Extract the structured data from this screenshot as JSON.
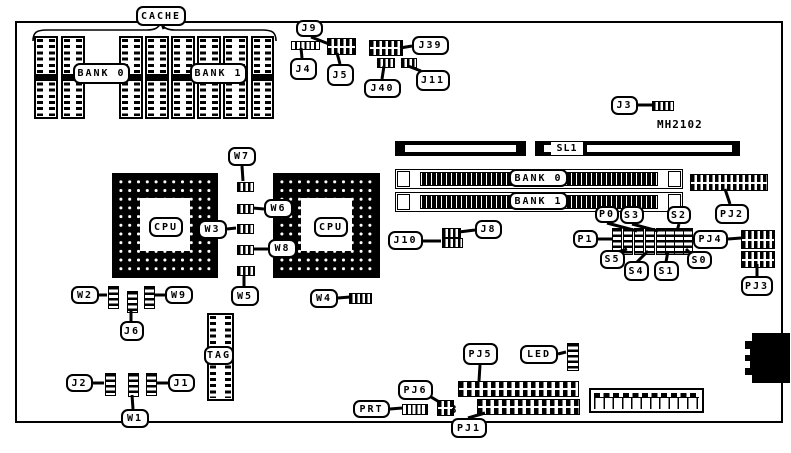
{
  "board": {
    "part_number": "MH2102",
    "ink": "#000000",
    "paper": "#ffffff"
  },
  "floating_texts": [
    {
      "id": "part-number",
      "text": "MH2102",
      "x": 657,
      "y": 118
    },
    {
      "id": "pj6-pin-3",
      "text": "3",
      "x": 450,
      "y": 403
    }
  ],
  "labels": [
    {
      "id": "cache",
      "text": "CACHE",
      "x": 136,
      "y": 6,
      "w": 50,
      "h": 20,
      "tail": [
        162,
        24,
        164,
        29
      ]
    },
    {
      "id": "cache-bank0",
      "text": "BANK 0",
      "x": 73,
      "y": 63,
      "w": 57,
      "h": 21,
      "tail": null
    },
    {
      "id": "cache-bank1",
      "text": "BANK 1",
      "x": 190,
      "y": 63,
      "w": 57,
      "h": 21,
      "tail": null
    },
    {
      "id": "j9",
      "text": "J9",
      "x": 296,
      "y": 20,
      "w": 27,
      "h": 17,
      "tail": [
        311,
        37,
        329,
        44
      ]
    },
    {
      "id": "j4",
      "text": "J4",
      "x": 290,
      "y": 58,
      "w": 27,
      "h": 22,
      "tail": [
        302,
        58,
        301,
        48
      ]
    },
    {
      "id": "j5",
      "text": "J5",
      "x": 327,
      "y": 64,
      "w": 27,
      "h": 22,
      "tail": [
        340,
        64,
        337,
        53
      ]
    },
    {
      "id": "j39",
      "text": "J39",
      "x": 412,
      "y": 36,
      "w": 37,
      "h": 19,
      "tail": [
        412,
        46,
        400,
        48
      ]
    },
    {
      "id": "j40",
      "text": "J40",
      "x": 364,
      "y": 79,
      "w": 37,
      "h": 19,
      "tail": [
        382,
        79,
        384,
        66
      ]
    },
    {
      "id": "j11",
      "text": "J11",
      "x": 416,
      "y": 70,
      "w": 34,
      "h": 21,
      "tail": [
        421,
        71,
        408,
        66
      ]
    },
    {
      "id": "j3",
      "text": "J3",
      "x": 611,
      "y": 96,
      "w": 27,
      "h": 19,
      "tail": [
        638,
        105,
        653,
        105
      ]
    },
    {
      "id": "sl1",
      "text": "SL1",
      "x": 551,
      "y": 142,
      "w": 32,
      "h": 13,
      "flat": true,
      "tail": null
    },
    {
      "id": "simm-bank0",
      "text": "BANK 0",
      "x": 509,
      "y": 169,
      "w": 59,
      "h": 18,
      "tail": null
    },
    {
      "id": "simm-bank1",
      "text": "BANK 1",
      "x": 509,
      "y": 192,
      "w": 59,
      "h": 18,
      "tail": null
    },
    {
      "id": "pj2",
      "text": "PJ2",
      "x": 715,
      "y": 204,
      "w": 34,
      "h": 20,
      "tail": [
        730,
        204,
        725,
        189
      ]
    },
    {
      "id": "w7",
      "text": "W7",
      "x": 228,
      "y": 147,
      "w": 28,
      "h": 19,
      "tail": [
        242,
        166,
        243,
        181
      ]
    },
    {
      "id": "w6",
      "text": "W6",
      "x": 264,
      "y": 199,
      "w": 29,
      "h": 19,
      "tail": [
        264,
        209,
        253,
        208
      ]
    },
    {
      "id": "w3",
      "text": "W3",
      "x": 198,
      "y": 220,
      "w": 29,
      "h": 19,
      "tail": [
        227,
        229,
        236,
        228
      ]
    },
    {
      "id": "w8",
      "text": "W8",
      "x": 268,
      "y": 239,
      "w": 29,
      "h": 19,
      "tail": [
        268,
        249,
        253,
        249
      ]
    },
    {
      "id": "w5",
      "text": "W5",
      "x": 231,
      "y": 286,
      "w": 28,
      "h": 20,
      "tail": [
        244,
        286,
        244,
        275
      ]
    },
    {
      "id": "w4",
      "text": "W4",
      "x": 310,
      "y": 289,
      "w": 28,
      "h": 19,
      "tail": [
        338,
        298,
        350,
        297
      ]
    },
    {
      "id": "w2",
      "text": "W2",
      "x": 71,
      "y": 286,
      "w": 28,
      "h": 18,
      "tail": [
        99,
        295,
        107,
        295
      ]
    },
    {
      "id": "w9",
      "text": "W9",
      "x": 165,
      "y": 286,
      "w": 28,
      "h": 18,
      "tail": [
        165,
        295,
        154,
        295
      ]
    },
    {
      "id": "j6",
      "text": "J6",
      "x": 120,
      "y": 321,
      "w": 24,
      "h": 20,
      "tail": [
        131,
        321,
        131,
        310
      ]
    },
    {
      "id": "j10",
      "text": "J10",
      "x": 388,
      "y": 231,
      "w": 35,
      "h": 19,
      "tail": [
        423,
        241,
        441,
        241
      ]
    },
    {
      "id": "j8",
      "text": "J8",
      "x": 475,
      "y": 220,
      "w": 27,
      "h": 19,
      "tail": [
        475,
        230,
        459,
        232
      ]
    },
    {
      "id": "p0",
      "text": "P0",
      "x": 595,
      "y": 206,
      "w": 24,
      "h": 17,
      "tail": [
        607,
        223,
        637,
        231
      ]
    },
    {
      "id": "s3",
      "text": "S3",
      "x": 620,
      "y": 206,
      "w": 24,
      "h": 18,
      "tail": [
        632,
        224,
        658,
        231
      ]
    },
    {
      "id": "s2",
      "text": "S2",
      "x": 667,
      "y": 206,
      "w": 24,
      "h": 18,
      "tail": [
        679,
        224,
        677,
        231
      ]
    },
    {
      "id": "p1",
      "text": "P1",
      "x": 573,
      "y": 230,
      "w": 25,
      "h": 18,
      "tail": [
        598,
        239,
        612,
        239
      ]
    },
    {
      "id": "s5",
      "text": "S5",
      "x": 600,
      "y": 250,
      "w": 25,
      "h": 19,
      "tail": [
        618,
        252,
        627,
        249
      ]
    },
    {
      "id": "s4",
      "text": "S4",
      "x": 624,
      "y": 261,
      "w": 25,
      "h": 20,
      "tail": [
        637,
        262,
        648,
        251
      ]
    },
    {
      "id": "s1",
      "text": "S1",
      "x": 654,
      "y": 261,
      "w": 25,
      "h": 20,
      "tail": [
        666,
        262,
        668,
        251
      ]
    },
    {
      "id": "s0",
      "text": "S0",
      "x": 687,
      "y": 251,
      "w": 25,
      "h": 18,
      "tail": [
        690,
        253,
        686,
        249
      ]
    },
    {
      "id": "pj4",
      "text": "PJ4",
      "x": 693,
      "y": 230,
      "w": 35,
      "h": 19,
      "tail": [
        728,
        239,
        741,
        238
      ]
    },
    {
      "id": "pj3",
      "text": "PJ3",
      "x": 741,
      "y": 276,
      "w": 32,
      "h": 20,
      "tail": [
        757,
        276,
        757,
        264
      ]
    },
    {
      "id": "tag",
      "text": "TAG",
      "x": 204,
      "y": 346,
      "w": 30,
      "h": 19,
      "tail": null
    },
    {
      "id": "j2",
      "text": "J2",
      "x": 66,
      "y": 374,
      "w": 27,
      "h": 18,
      "tail": [
        93,
        383,
        104,
        383
      ]
    },
    {
      "id": "j1",
      "text": "J1",
      "x": 168,
      "y": 374,
      "w": 27,
      "h": 18,
      "tail": [
        168,
        383,
        156,
        383
      ]
    },
    {
      "id": "w1",
      "text": "W1",
      "x": 121,
      "y": 409,
      "w": 28,
      "h": 19,
      "tail": [
        133,
        409,
        132,
        395
      ]
    },
    {
      "id": "pj5",
      "text": "PJ5",
      "x": 463,
      "y": 343,
      "w": 35,
      "h": 22,
      "tail": [
        480,
        365,
        479,
        381
      ]
    },
    {
      "id": "led",
      "text": "LED",
      "x": 520,
      "y": 345,
      "w": 38,
      "h": 19,
      "tail": [
        558,
        354,
        566,
        352
      ]
    },
    {
      "id": "pj6",
      "text": "PJ6",
      "x": 398,
      "y": 380,
      "w": 35,
      "h": 20,
      "tail": [
        431,
        397,
        441,
        403
      ]
    },
    {
      "id": "prt",
      "text": "PRT",
      "x": 353,
      "y": 400,
      "w": 37,
      "h": 18,
      "tail": [
        390,
        409,
        402,
        408
      ]
    },
    {
      "id": "pj1",
      "text": "PJ1",
      "x": 451,
      "y": 418,
      "w": 36,
      "h": 20,
      "tail": [
        468,
        418,
        485,
        413
      ]
    }
  ],
  "dip_chips": [
    {
      "id": "cache-chip-1",
      "x": 34,
      "y": 36,
      "w": 24,
      "h": 83
    },
    {
      "id": "cache-chip-2",
      "x": 61,
      "y": 36,
      "w": 24,
      "h": 83
    },
    {
      "id": "cache-chip-3",
      "x": 119,
      "y": 36,
      "w": 24,
      "h": 83
    },
    {
      "id": "cache-chip-4",
      "x": 145,
      "y": 36,
      "w": 24,
      "h": 83
    },
    {
      "id": "cache-chip-5",
      "x": 171,
      "y": 36,
      "w": 24,
      "h": 83
    },
    {
      "id": "cache-chip-6",
      "x": 197,
      "y": 36,
      "w": 24,
      "h": 83
    },
    {
      "id": "cache-chip-7",
      "x": 223,
      "y": 36,
      "w": 25,
      "h": 83
    },
    {
      "id": "cache-chip-8",
      "x": 251,
      "y": 36,
      "w": 23,
      "h": 83
    },
    {
      "id": "tag-chip",
      "x": 207,
      "y": 313,
      "w": 27,
      "h": 88
    }
  ],
  "cpu_sockets": [
    {
      "id": "cpu-socket-left",
      "label": "CPU",
      "x": 112,
      "y": 173,
      "w": 106,
      "h": 105,
      "ctr": {
        "x": 28,
        "y": 25,
        "w": 50,
        "h": 53
      },
      "lbl": {
        "x": 149,
        "y": 217,
        "w": 34,
        "h": 20
      }
    },
    {
      "id": "cpu-socket-right",
      "label": "CPU",
      "x": 273,
      "y": 173,
      "w": 107,
      "h": 105,
      "ctr": {
        "x": 28,
        "y": 25,
        "w": 51,
        "h": 53
      },
      "lbl": {
        "x": 314,
        "y": 217,
        "w": 34,
        "h": 20
      }
    }
  ],
  "simm_sockets": [
    {
      "id": "simm-socket-bank0",
      "x": 395,
      "y": 169,
      "w": 288,
      "h": 20
    },
    {
      "id": "simm-socket-bank1",
      "x": 395,
      "y": 192,
      "w": 288,
      "h": 20
    }
  ],
  "edge_slots": [
    {
      "id": "expansion-slot-left",
      "x": 395,
      "y": 141,
      "w": 131,
      "h": 15,
      "wins": [
        {
          "x": 10,
          "y": 4,
          "w": 111,
          "h": 7
        }
      ]
    },
    {
      "id": "expansion-slot-sl1",
      "x": 535,
      "y": 141,
      "w": 205,
      "h": 15,
      "wins": [
        {
          "x": 9,
          "y": 4,
          "w": 7,
          "h": 7
        },
        {
          "x": 52,
          "y": 4,
          "w": 145,
          "h": 7
        }
      ]
    }
  ],
  "connectors": [
    {
      "id": "j4-connector",
      "type": "bar",
      "x": 291,
      "y": 41,
      "w": 27,
      "h": 7
    },
    {
      "id": "j5-j9-connector",
      "type": "grid",
      "x": 327,
      "y": 38,
      "w": 27,
      "h": 15
    },
    {
      "id": "j39-connector",
      "type": "grid",
      "x": 369,
      "y": 40,
      "w": 32,
      "h": 14
    },
    {
      "id": "j40-connector",
      "type": "hjump",
      "x": 377,
      "y": 58,
      "w": 16,
      "h": 8
    },
    {
      "id": "j11-connector",
      "type": "hjump",
      "x": 401,
      "y": 58,
      "w": 14,
      "h": 8
    },
    {
      "id": "j3-connector",
      "type": "hjump",
      "x": 652,
      "y": 101,
      "w": 20,
      "h": 8
    },
    {
      "id": "j8-connector",
      "type": "hjump",
      "x": 442,
      "y": 228,
      "w": 17,
      "h": 8
    },
    {
      "id": "j10-connector",
      "type": "hjump",
      "x": 442,
      "y": 238,
      "w": 19,
      "h": 8
    },
    {
      "id": "w7-jumper",
      "type": "hjump",
      "x": 237,
      "y": 182,
      "w": 15,
      "h": 8
    },
    {
      "id": "w6-jumper",
      "type": "hjump",
      "x": 237,
      "y": 204,
      "w": 15,
      "h": 8
    },
    {
      "id": "w3-jumper",
      "type": "hjump",
      "x": 237,
      "y": 224,
      "w": 15,
      "h": 8
    },
    {
      "id": "w8-jumper",
      "type": "hjump",
      "x": 237,
      "y": 245,
      "w": 15,
      "h": 8
    },
    {
      "id": "w5-jumper",
      "type": "hjump",
      "x": 237,
      "y": 266,
      "w": 16,
      "h": 8
    },
    {
      "id": "w4-jumper",
      "type": "hjump",
      "x": 349,
      "y": 293,
      "w": 21,
      "h": 9
    },
    {
      "id": "w2-jumper",
      "type": "vjump",
      "x": 108,
      "y": 286,
      "w": 9,
      "h": 21
    },
    {
      "id": "j6-jumper",
      "type": "vjump",
      "x": 127,
      "y": 291,
      "w": 9,
      "h": 20
    },
    {
      "id": "w9-jumper",
      "type": "vjump",
      "x": 144,
      "y": 286,
      "w": 9,
      "h": 21
    },
    {
      "id": "j2-jumper",
      "type": "vjump",
      "x": 105,
      "y": 373,
      "w": 9,
      "h": 21
    },
    {
      "id": "w1-jumper",
      "type": "vjump",
      "x": 128,
      "y": 373,
      "w": 9,
      "h": 22
    },
    {
      "id": "j1-jumper",
      "type": "vjump",
      "x": 146,
      "y": 373,
      "w": 9,
      "h": 21
    },
    {
      "id": "p1-jumper",
      "type": "vjump",
      "x": 612,
      "y": 228,
      "w": 8,
      "h": 25
    },
    {
      "id": "s5-jumper",
      "type": "vjump",
      "x": 623,
      "y": 228,
      "w": 8,
      "h": 25
    },
    {
      "id": "p0-jumper",
      "type": "vjump",
      "x": 634,
      "y": 228,
      "w": 8,
      "h": 25
    },
    {
      "id": "s4-jumper",
      "type": "vjump",
      "x": 645,
      "y": 228,
      "w": 8,
      "h": 25
    },
    {
      "id": "s3-jumper",
      "type": "vjump",
      "x": 656,
      "y": 228,
      "w": 8,
      "h": 25
    },
    {
      "id": "s1-jumper",
      "type": "vjump",
      "x": 665,
      "y": 228,
      "w": 8,
      "h": 25
    },
    {
      "id": "s2-jumper",
      "type": "vjump",
      "x": 674,
      "y": 228,
      "w": 8,
      "h": 25
    },
    {
      "id": "s0-jumper",
      "type": "vjump",
      "x": 683,
      "y": 228,
      "w": 8,
      "h": 25
    },
    {
      "id": "pj2-connector",
      "type": "grid",
      "x": 690,
      "y": 174,
      "w": 76,
      "h": 15
    },
    {
      "id": "pj4-connector",
      "type": "grid",
      "x": 741,
      "y": 230,
      "w": 32,
      "h": 17
    },
    {
      "id": "pj3-connector",
      "type": "grid",
      "x": 741,
      "y": 251,
      "w": 32,
      "h": 15
    },
    {
      "id": "pj5-connector",
      "type": "pinrow",
      "x": 458,
      "y": 381,
      "w": 119,
      "h": 14
    },
    {
      "id": "pj1-connector",
      "type": "pinrow",
      "x": 477,
      "y": 399,
      "w": 101,
      "h": 14
    },
    {
      "id": "pj6-connector",
      "type": "grid",
      "x": 437,
      "y": 400,
      "w": 15,
      "h": 14
    },
    {
      "id": "prt-connector",
      "type": "bar",
      "x": 402,
      "y": 404,
      "w": 24,
      "h": 9
    },
    {
      "id": "led-connector",
      "type": "vjump",
      "x": 567,
      "y": 343,
      "w": 10,
      "h": 26
    }
  ],
  "power_connector": {
    "id": "power-connector",
    "x": 589,
    "y": 388,
    "w": 115,
    "h": 25
  },
  "keyboard_din": {
    "id": "keyboard-din-connector",
    "body": {
      "x": 752,
      "y": 333,
      "w": 38,
      "h": 50
    },
    "strip": {
      "x": 745,
      "y": 341,
      "w": 8,
      "h": 34
    },
    "notches": [
      {
        "x": 745,
        "y": 349,
        "w": 5,
        "h": 6
      },
      {
        "x": 745,
        "y": 361,
        "w": 5,
        "h": 7
      }
    ]
  }
}
